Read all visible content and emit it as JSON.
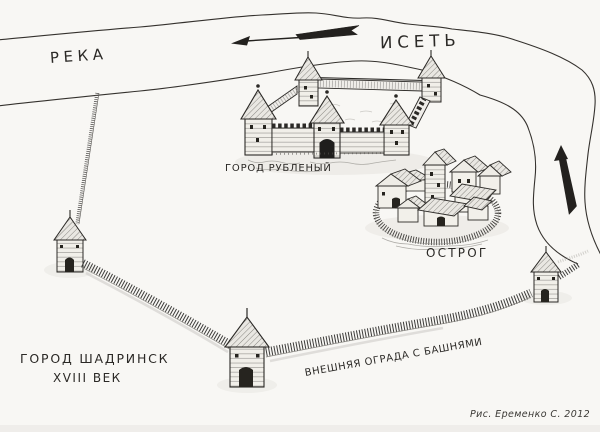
{
  "page": {
    "colors": {
      "paper": "#f8f7f4",
      "ink": "#2b2926",
      "pencil_shade": "#c9c7c2"
    }
  },
  "labels": {
    "river_generic": "РЕКА",
    "river_name": "ИСЕТЬ",
    "log_town": "ГОРОД РУБЛЕНЫЙ",
    "ostrog": "ОСТРОГ",
    "outer_fence": "ВНЕШНЯЯ ОГРАДА С БАШНЯМИ",
    "title_line1": "ГОРОД ШАДРИНСК",
    "title_line2": "XVIII ВЕК",
    "credit": "Рис. Еременко С. 2012"
  },
  "icons": {
    "flow_arrow": "river-flow-arrow-pointing-left",
    "north_arrow": "north-arrow-pointing-up"
  }
}
